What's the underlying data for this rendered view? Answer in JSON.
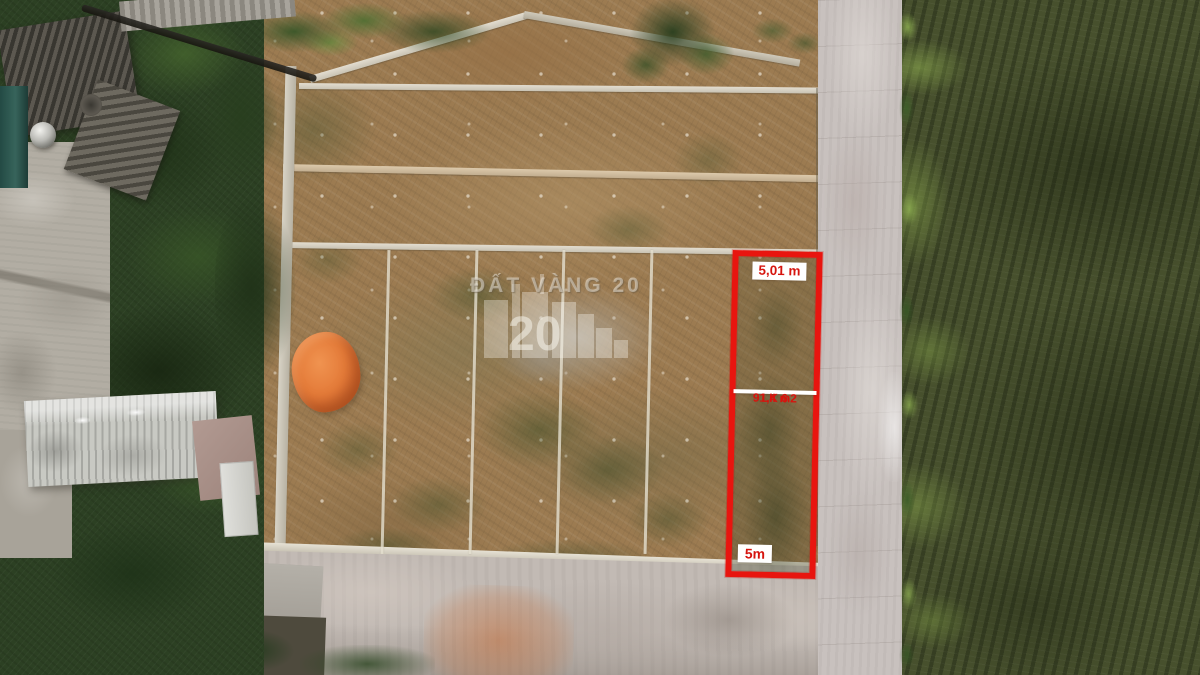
{
  "plot": {
    "name": "LK 6",
    "area": "91,4 m2",
    "width_top": "5,01 m",
    "width_bottom": "5m",
    "outline_color": "#e8150f",
    "label_bg": "#ffffff",
    "label_text_color": "#d6140e"
  },
  "watermark": {
    "text": "ĐẤT VÀNG 20",
    "logo_digits": "20"
  }
}
